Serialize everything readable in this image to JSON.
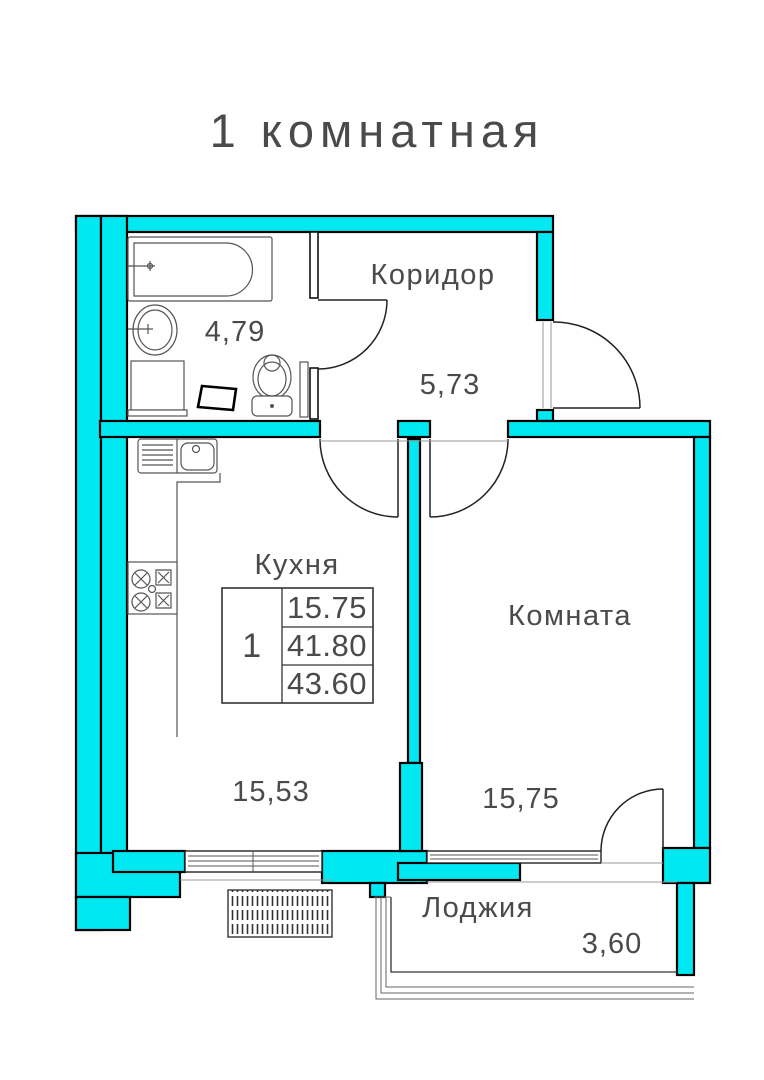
{
  "title": "1 комнатная",
  "colors": {
    "wall_fill": "#00e9f2",
    "wall_outline": "#000000",
    "drawing_lines": "#555555",
    "text": "#4a4a4a"
  },
  "rooms": {
    "bathroom": {
      "area": "4,79"
    },
    "corridor": {
      "name": "Коридор",
      "area": "5,73"
    },
    "kitchen": {
      "name": "Кухня",
      "area": "15,53"
    },
    "room": {
      "name": "Комната",
      "area": "15,75"
    },
    "loggia": {
      "name": "Лоджия",
      "area": "3,60"
    }
  },
  "info_table": {
    "rooms_count": "1",
    "living_area": "15.75",
    "apartment_area": "41.80",
    "total_area": "43.60"
  }
}
